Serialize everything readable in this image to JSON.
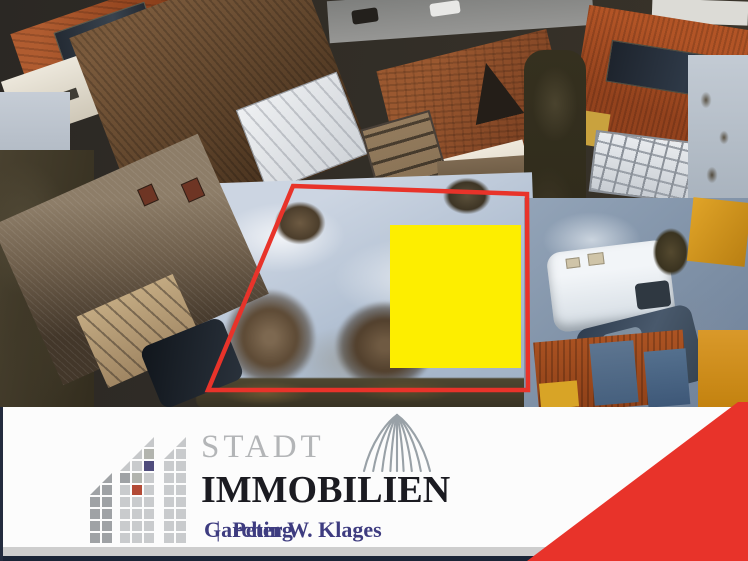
{
  "colors": {
    "plot_outline": "#e8332a",
    "highlight_square": "#fdee00",
    "brand_red": "#e8332a",
    "title_color": "#b3b5b7",
    "subtitle_color": "#1b1b21",
    "tagline_color": "#3e3c80",
    "logo_navy": "#4f4c7c",
    "logo_red": "#b34a35",
    "banner_bg": "#fcfcfc"
  },
  "banner": {
    "title": "STADT",
    "subtitle": "IMMOBILIEN",
    "tagline_left": "Garching",
    "tagline_separator": "|",
    "tagline_right": "Peter W. Klages"
  },
  "logo": {
    "icon_names": [
      "pixel-building-icon",
      "dome-icon"
    ],
    "rows": [
      "....t.t",
      "...tmts",
      "..tsNss",
      ".vxmsss",
      "vxsRsss",
      "xxsssss",
      "xxsssss",
      "xxsssss",
      "xxsssss"
    ],
    "col_x": [
      0,
      12,
      30,
      42,
      54,
      74,
      86
    ],
    "row_pitch": 12,
    "palette": {
      "s": {
        "color": "#c9cbcd"
      },
      "x": {
        "color": "#9fa2a5"
      },
      "m": {
        "color": "#b2b4ae"
      },
      "N": {
        "color": "#4f4c7c"
      },
      "R": {
        "color": "#b34a35"
      },
      "t": {
        "color": "#c6c8ca",
        "tri": true
      },
      "v": {
        "color": "#a0a3a6",
        "tri": true
      }
    }
  },
  "overlay": {
    "plot_boundary": {
      "type": "polygon",
      "points": [
        [
          293,
          186
        ],
        [
          527,
          194
        ],
        [
          528,
          390
        ],
        [
          208,
          390
        ]
      ],
      "stroke_width": 4.5
    },
    "highlight_square": {
      "x": 390,
      "y": 225,
      "width": 131,
      "height": 143
    }
  }
}
